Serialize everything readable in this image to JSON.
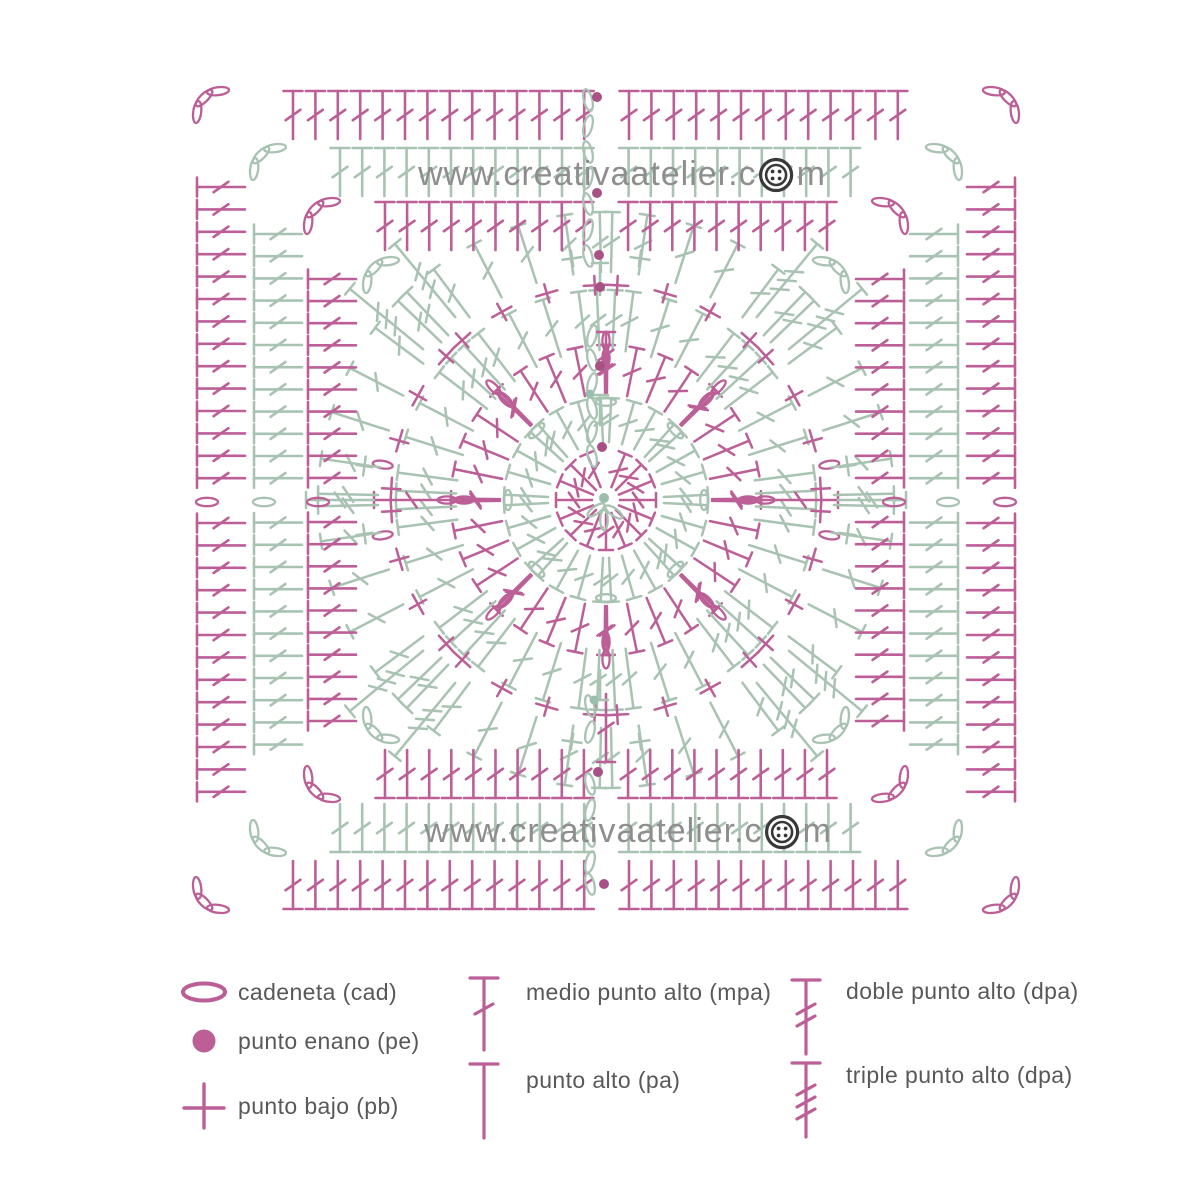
{
  "watermark": {
    "full_text": "www.creativaatelier.com",
    "prefix": "www.creativaatelier.c",
    "suffix": "m"
  },
  "colors": {
    "pink": "#bc5f97",
    "green": "#a9c3b2",
    "pink_dot": "#a85184",
    "green_dot": "#9cbfad",
    "watermark": "#8e8e8e",
    "button": "#383838",
    "legend_text": "#58585a"
  },
  "legend": {
    "items": [
      {
        "label": "cadeneta (cad)",
        "symbol": "chain"
      },
      {
        "label": "punto enano (pe)",
        "symbol": "slip-stitch"
      },
      {
        "label": "punto bajo (pb)",
        "symbol": "single-crochet"
      },
      {
        "label": "medio punto alto (mpa)",
        "symbol": "half-double"
      },
      {
        "label": "punto alto (pa)",
        "symbol": "double"
      },
      {
        "label": "doble punto alto (dpa)",
        "symbol": "treble"
      },
      {
        "label": "triple punto alto (dpa)",
        "symbol": "double-treble"
      }
    ]
  },
  "diagram": {
    "center": {
      "x": 606,
      "y": 500
    },
    "rounds": [
      {
        "name": "round-1-center",
        "type": "radial",
        "color": "pink",
        "count": 16,
        "r0": 14,
        "r1": 50,
        "skip_top": true
      },
      {
        "name": "round-2",
        "type": "fans",
        "color": "green",
        "fans": 8,
        "per": 4,
        "step": 13,
        "r0": 58,
        "r1": 102,
        "chain": "tangent",
        "chainR": 98
      },
      {
        "name": "round-3",
        "type": "fans",
        "color": "pink",
        "fans": 8,
        "per": 5,
        "step": 11,
        "r0": 106,
        "r1": 155,
        "chain": "radial2",
        "chainR": 142
      },
      {
        "name": "round-4",
        "type": "fans",
        "color": "green",
        "fans": 8,
        "per": 6,
        "step": 10,
        "r0": 150,
        "r1": 210
      },
      {
        "name": "round-5",
        "type": "plus-spokes",
        "color": "pink",
        "fans": 8,
        "plus_per": 4,
        "plusR": 215,
        "spoke_r1": 232,
        "spoke_len": 75
      },
      {
        "name": "round-6",
        "type": "fans",
        "color": "green",
        "fans": 8,
        "per": 6,
        "step": 9.5,
        "r0": 228,
        "r1": 288,
        "axis_spokes": true,
        "corners": true,
        "corner_r1": 332,
        "corner_len": 95,
        "arcR": 304
      },
      {
        "name": "round-7-square",
        "type": "square",
        "color": "pink",
        "half": 298,
        "extent": 221,
        "spacing": 22.1
      },
      {
        "name": "round-8-square",
        "type": "square",
        "color": "green",
        "half": 352,
        "extent": 266,
        "spacing": 22.2
      },
      {
        "name": "round-9-square",
        "type": "square",
        "color": "pink",
        "half": 409,
        "extent": 313,
        "spacing": 22.4
      }
    ]
  }
}
